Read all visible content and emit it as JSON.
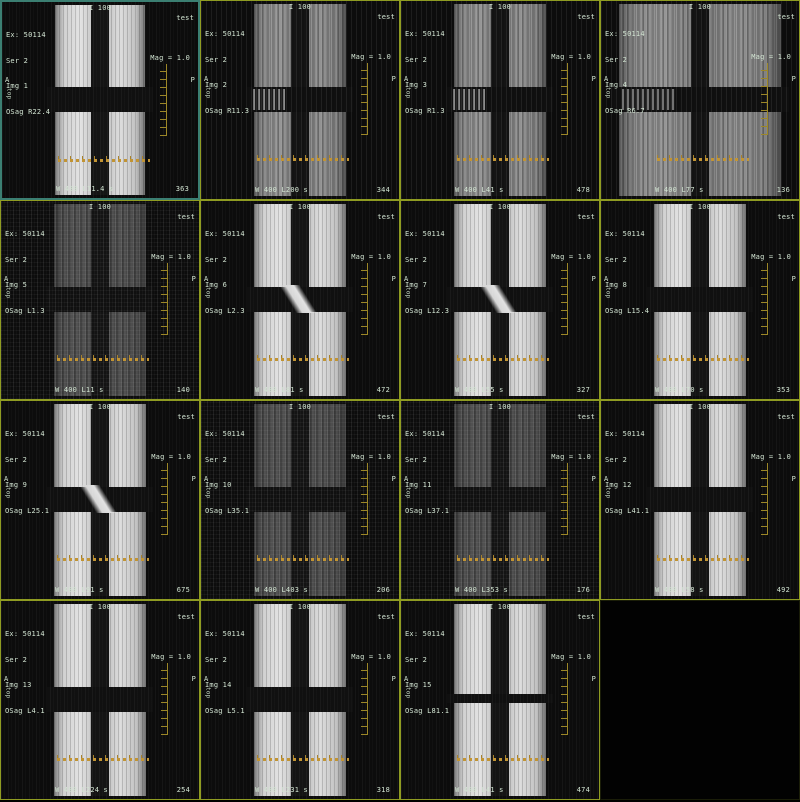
{
  "app": {
    "description": "MRI multi-image film layout, sagittal phantom test scans",
    "grid": {
      "columns": 4,
      "rows": 4,
      "image_count": 15
    }
  },
  "palette": {
    "background": "#000000",
    "grid_line": "#8f9c22",
    "selected_border": "#3b7f72",
    "annotation_text": "#d2e4d2",
    "ruler": "#c29433"
  },
  "panels": [
    {
      "ex": "Ex: 50114",
      "ser": "Ser 2",
      "img": "Img 1",
      "osag": "OSag R22.4",
      "top_center": "I 100",
      "top_right": "test",
      "mag": "Mag = 1.0",
      "left_letter": "A",
      "left_sub": "top",
      "right_letter": "P",
      "bottom_left": "W 400 L11.4 s",
      "bottom_right": "363",
      "variant": "bright",
      "selected": true
    },
    {
      "ex": "Ex: 50114",
      "ser": "Ser 2",
      "img": "Img 2",
      "osag": "OSag R11.3",
      "top_center": "I 100",
      "top_right": "test",
      "mag": "Mag = 1.0",
      "left_letter": "A",
      "left_sub": "top",
      "right_letter": "P",
      "bottom_left": "W 400 L200 s",
      "bottom_right": "344",
      "variant": "gray"
    },
    {
      "ex": "Ex: 50114",
      "ser": "Ser 2",
      "img": "Img 3",
      "osag": "OSag R1.3",
      "top_center": "I 100",
      "top_right": "test",
      "mag": "Mag = 1.0",
      "left_letter": "A",
      "left_sub": "top",
      "right_letter": "P",
      "bottom_left": "W 400 L41 s",
      "bottom_right": "478",
      "variant": "gray"
    },
    {
      "ex": "Ex: 50114",
      "ser": "Ser 2",
      "img": "Img 4",
      "osag": "OSag R6.7",
      "top_center": "I 100",
      "top_right": "test",
      "mag": "Mag = 1.0",
      "left_letter": "A",
      "left_sub": "top",
      "right_letter": "P",
      "bottom_left": "W 400 L77 s",
      "bottom_right": "136",
      "variant": "gray wide"
    },
    {
      "ex": "Ex: 50114",
      "ser": "Ser 2",
      "img": "Img 5",
      "osag": "OSag L1.3",
      "top_center": "I 100",
      "top_right": "test",
      "mag": "Mag = 1.0",
      "left_letter": "A",
      "left_sub": "top",
      "right_letter": "P",
      "bottom_left": "W 400 L11 s",
      "bottom_right": "140",
      "variant": "dark"
    },
    {
      "ex": "Ex: 50114",
      "ser": "Ser 2",
      "img": "Img 6",
      "osag": "OSag L2.3",
      "top_center": "I 100",
      "top_right": "test",
      "mag": "Mag = 1.0",
      "left_letter": "A",
      "left_sub": "top",
      "right_letter": "P",
      "bottom_left": "W 400 L81 s",
      "bottom_right": "472",
      "variant": "bright diagonal"
    },
    {
      "ex": "Ex: 50114",
      "ser": "Ser 2",
      "img": "Img 7",
      "osag": "OSag L12.3",
      "top_center": "I 100",
      "top_right": "test",
      "mag": "Mag = 1.0",
      "left_letter": "A",
      "left_sub": "top",
      "right_letter": "P",
      "bottom_left": "W 400 L55 s",
      "bottom_right": "327",
      "variant": "bright diagonal"
    },
    {
      "ex": "Ex: 50114",
      "ser": "Ser 2",
      "img": "Img 8",
      "osag": "OSag L15.4",
      "top_center": "I 100",
      "top_right": "test",
      "mag": "Mag = 1.0",
      "left_letter": "A",
      "left_sub": "top",
      "right_letter": "P",
      "bottom_left": "W 400 L70 s",
      "bottom_right": "353",
      "variant": "bright"
    },
    {
      "ex": "Ex: 50114",
      "ser": "Ser 2",
      "img": "Img 9",
      "osag": "OSag L25.1",
      "top_center": "I 100",
      "top_right": "test",
      "mag": "Mag = 1.0",
      "left_letter": "A",
      "left_sub": "top",
      "right_letter": "P",
      "bottom_left": "W 400 L91 s",
      "bottom_right": "675",
      "variant": "bright diagonal"
    },
    {
      "ex": "Ex: 50114",
      "ser": "Ser 2",
      "img": "Img 10",
      "osag": "OSag L35.1",
      "top_center": "I 100",
      "top_right": "test",
      "mag": "Mag = 1.0",
      "left_letter": "A",
      "left_sub": "top",
      "right_letter": "P",
      "bottom_left": "W 400 L403 s",
      "bottom_right": "206",
      "variant": "dark"
    },
    {
      "ex": "Ex: 50114",
      "ser": "Ser 2",
      "img": "Img 11",
      "osag": "OSag L37.1",
      "top_center": "I 100",
      "top_right": "test",
      "mag": "Mag = 1.0",
      "left_letter": "A",
      "left_sub": "top",
      "right_letter": "P",
      "bottom_left": "W 400 L353 s",
      "bottom_right": "176",
      "variant": "dark"
    },
    {
      "ex": "Ex: 50114",
      "ser": "Ser 2",
      "img": "Img 12",
      "osag": "OSag L41.1",
      "top_center": "I 100",
      "top_right": "test",
      "mag": "Mag = 1.0",
      "left_letter": "A",
      "left_sub": "top",
      "right_letter": "P",
      "bottom_left": "W 400 L58 s",
      "bottom_right": "492",
      "variant": "bright"
    },
    {
      "ex": "Ex: 50114",
      "ser": "Ser 2",
      "img": "Img 13",
      "osag": "OSag L4.1",
      "top_center": "I 100",
      "top_right": "test",
      "mag": "Mag = 1.0",
      "left_letter": "A",
      "left_sub": "top",
      "right_letter": "P",
      "bottom_left": "W 400 L224 s",
      "bottom_right": "254",
      "variant": "bright"
    },
    {
      "ex": "Ex: 50114",
      "ser": "Ser 2",
      "img": "Img 14",
      "osag": "OSag L5.1",
      "top_center": "I 100",
      "top_right": "test",
      "mag": "Mag = 1.0",
      "left_letter": "A",
      "left_sub": "top",
      "right_letter": "P",
      "bottom_left": "W 400 L231 s",
      "bottom_right": "318",
      "variant": "bright"
    },
    {
      "ex": "Ex: 50114",
      "ser": "Ser 2",
      "img": "Img 15",
      "osag": "OSag L81.1",
      "top_center": "I 100",
      "top_right": "test",
      "mag": "Mag = 1.0",
      "left_letter": "A",
      "left_sub": "top",
      "right_letter": "P",
      "bottom_left": "W 400 L41 s",
      "bottom_right": "474",
      "variant": "bright thin"
    },
    {
      "variant": "empty"
    }
  ]
}
